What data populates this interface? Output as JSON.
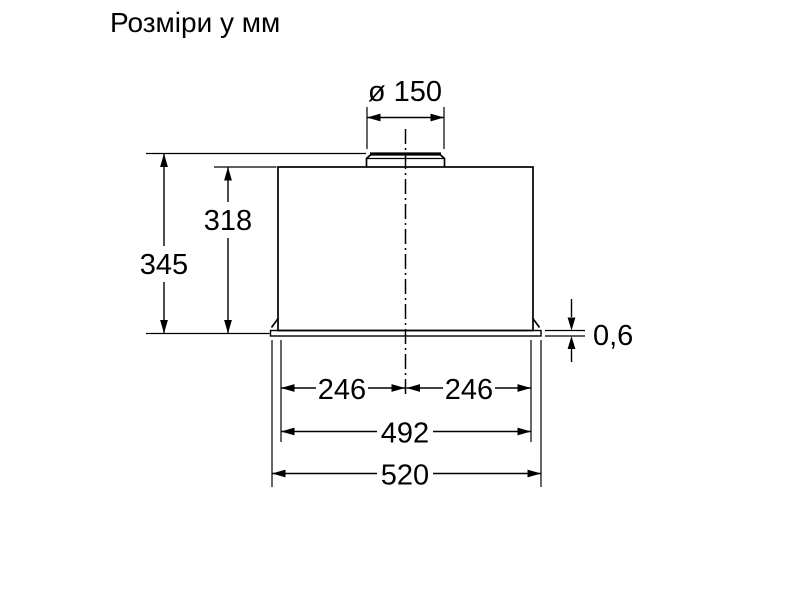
{
  "page": {
    "title": "Розміри у мм"
  },
  "diagram": {
    "type": "technical-dimension-drawing",
    "subject": "built-in cooker hood, front elevation",
    "units": "mm",
    "colors": {
      "background": "#ffffff",
      "lines": "#000000",
      "text": "#000000"
    },
    "dimensions": {
      "duct_diameter": "ø 150",
      "overall_height": "345",
      "body_height": "318",
      "bottom_panel_thickness": "0,6",
      "center_to_left_edge": "246",
      "center_to_right_edge": "246",
      "body_width": "492",
      "overall_width": "520"
    }
  }
}
